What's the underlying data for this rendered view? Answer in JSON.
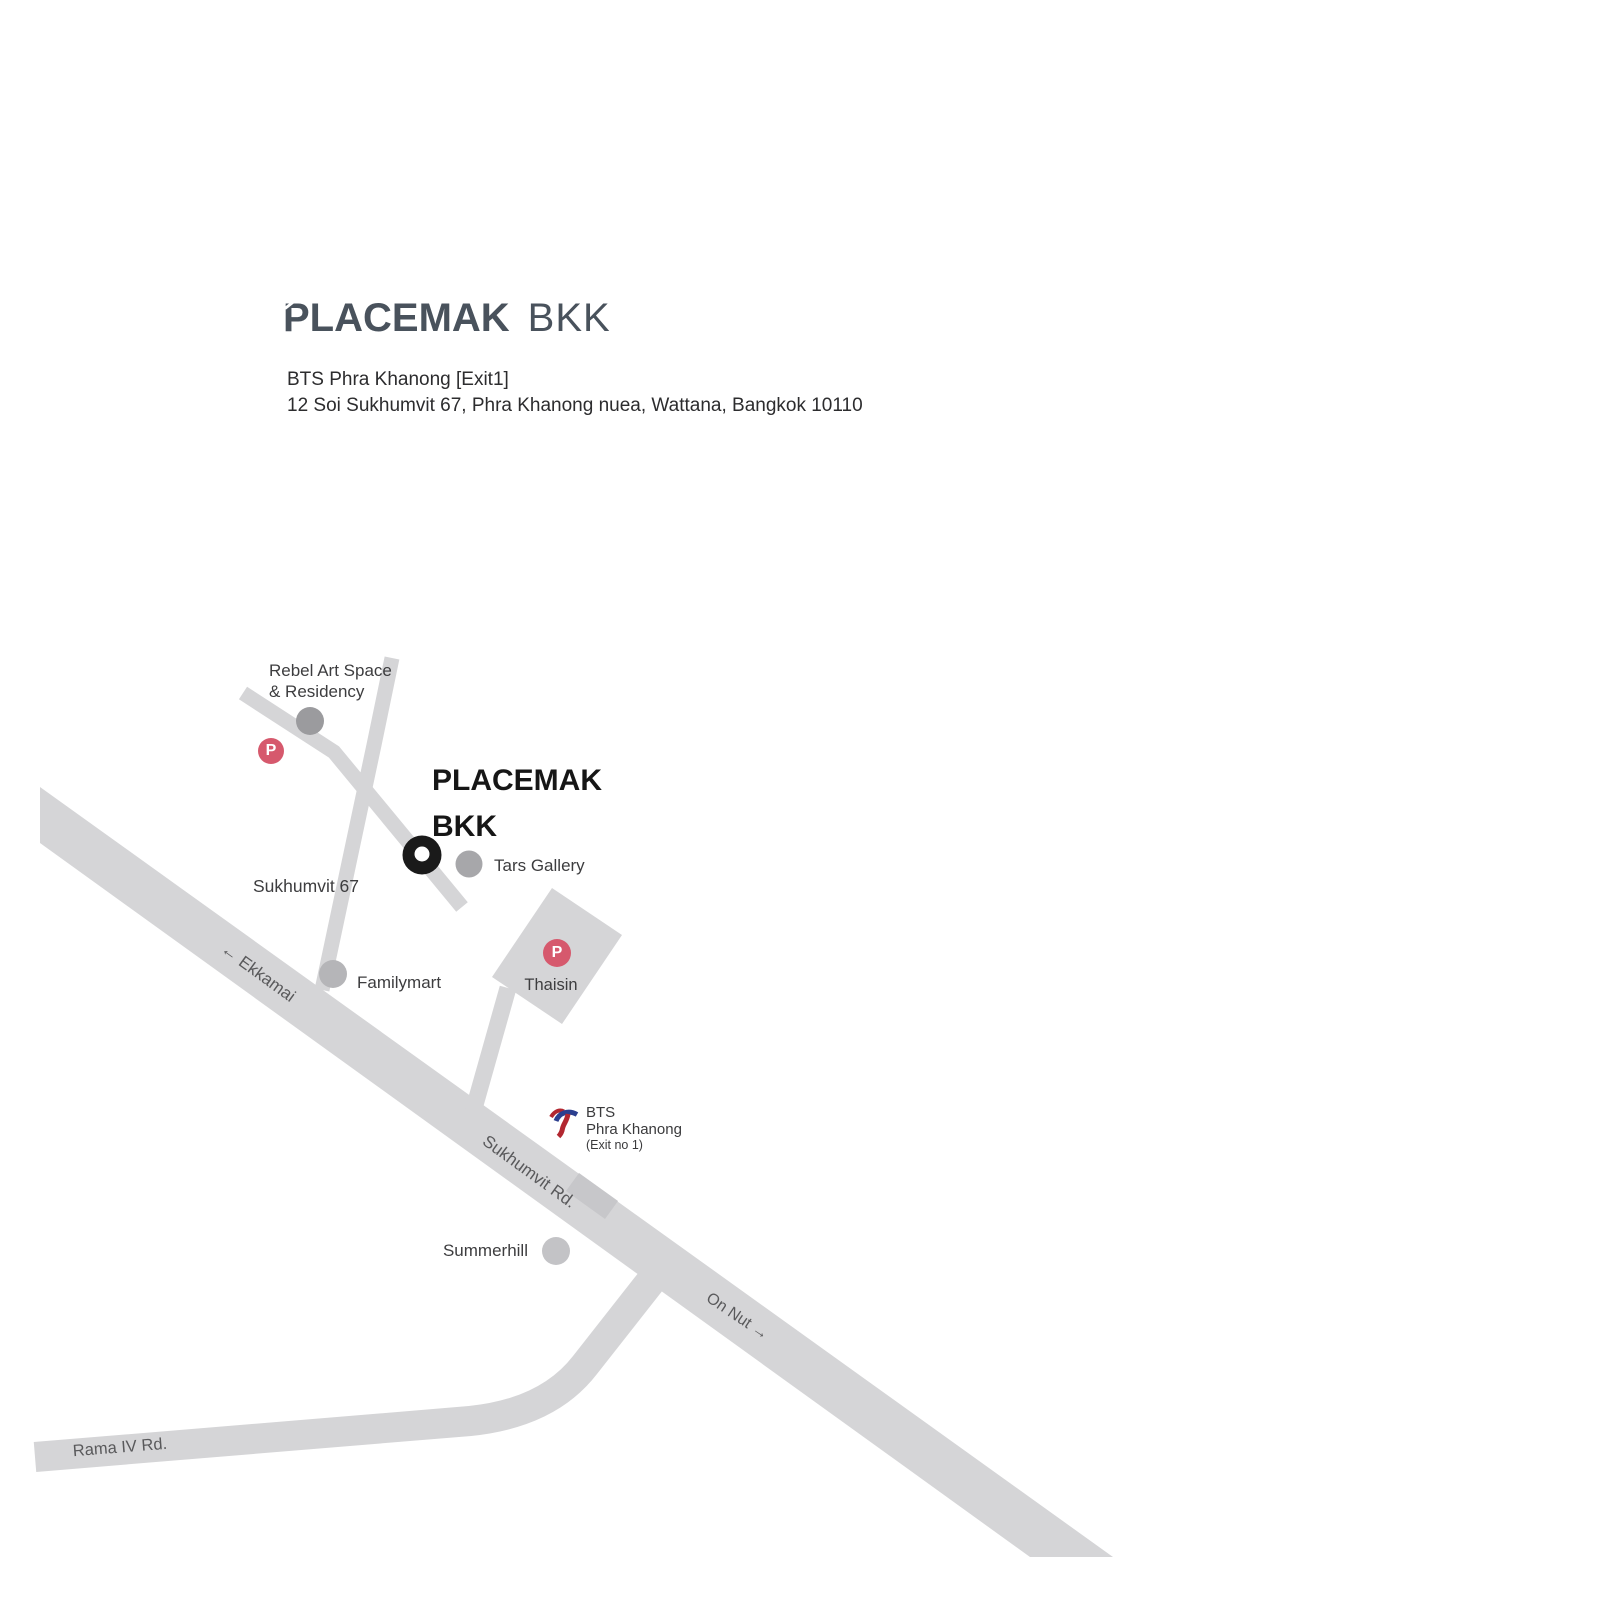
{
  "header": {
    "logo_main": "PLACEMAK",
    "logo_suffix": "BKK",
    "address_line1": "BTS Phra Khanong [Exit1]",
    "address_line2": "12 Soi Sukhumvit 67, Phra Khanong nuea, Wattana, Bangkok 10110"
  },
  "map": {
    "venue": {
      "logo_main": "PLACEMAK",
      "logo_suffix": "BKK",
      "marker_icon": "location-donut-marker"
    },
    "parking": {
      "symbol": "P"
    },
    "pois": {
      "rebel": {
        "line1": "Rebel Art Space",
        "line2": "& Residency",
        "icon": "gray-dot"
      },
      "tars": {
        "label": "Tars Gallery",
        "icon": "gray-dot"
      },
      "familymart": {
        "label": "Familymart",
        "icon": "gray-dot"
      },
      "thaisin": {
        "label": "Thaisin",
        "icon": "parking-circle"
      },
      "summerhill": {
        "label": "Summerhill",
        "icon": "gray-dot"
      }
    },
    "bts": {
      "line1": "BTS",
      "line2": "Phra Khanong",
      "line3": "(Exit no 1)",
      "icon": "bts-skytrain-logo"
    },
    "roads": {
      "soi": "Sukhumvit 67",
      "ekkamai": "← Ekkamai",
      "sukhumvit": "Sukhumvit Rd.",
      "onnut": "On Nut →",
      "rama4": "Rama IV Rd."
    }
  },
  "colors": {
    "road_gray": "#d5d5d7",
    "building_gray": "#d5d5d7",
    "station_gray": "#c7c7ca",
    "parking_pink": "#d6596d",
    "marker_black": "#1a1a1a",
    "logo_slate": "#49525c",
    "map_text": "#3d3d3f",
    "road_label_gray": "#59595b",
    "dot_rebel": "#9b9b9e",
    "dot_tars": "#a7a7aa",
    "dot_familymart": "#b5b5b8",
    "dot_summerhill": "#c3c3c6",
    "bts_blue": "#2c3f8f",
    "bts_red": "#b22730"
  }
}
